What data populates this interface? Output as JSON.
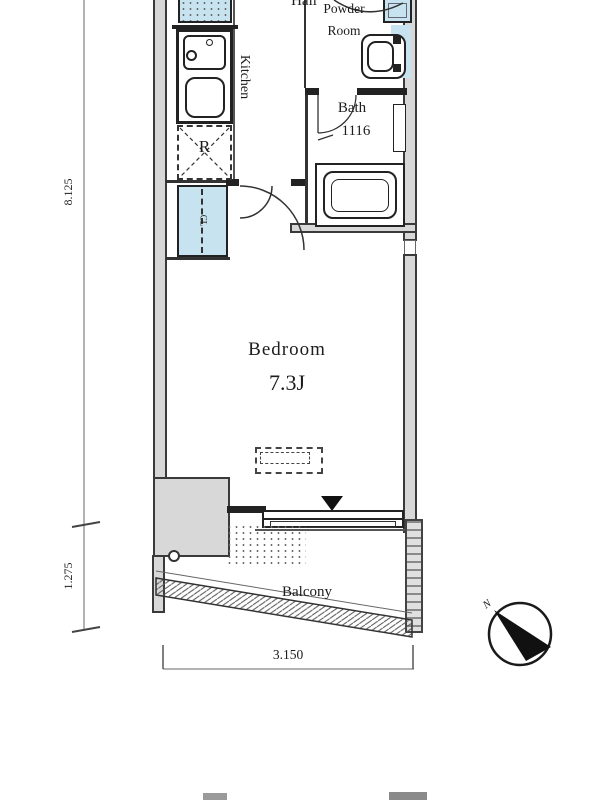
{
  "rooms": {
    "hall": "Hall",
    "kitchen": "Kitchen",
    "powder_room_line1": "Powder",
    "powder_room_line2": "Room",
    "bath_name": "Bath",
    "bath_size": "1116",
    "bedroom_name": "Bedroom",
    "bedroom_size": "7.3J",
    "balcony": "Balcony"
  },
  "fixtures": {
    "refrigerator": "R",
    "closet": "CL"
  },
  "dimensions": {
    "main_height": "8.125",
    "balcony_height": "1.275",
    "width": "3.150"
  },
  "compass": {
    "north": "N"
  },
  "colors": {
    "wall_fill": "#d8d8d8",
    "water_feature": "#c8e3f0",
    "line": "#222222"
  }
}
